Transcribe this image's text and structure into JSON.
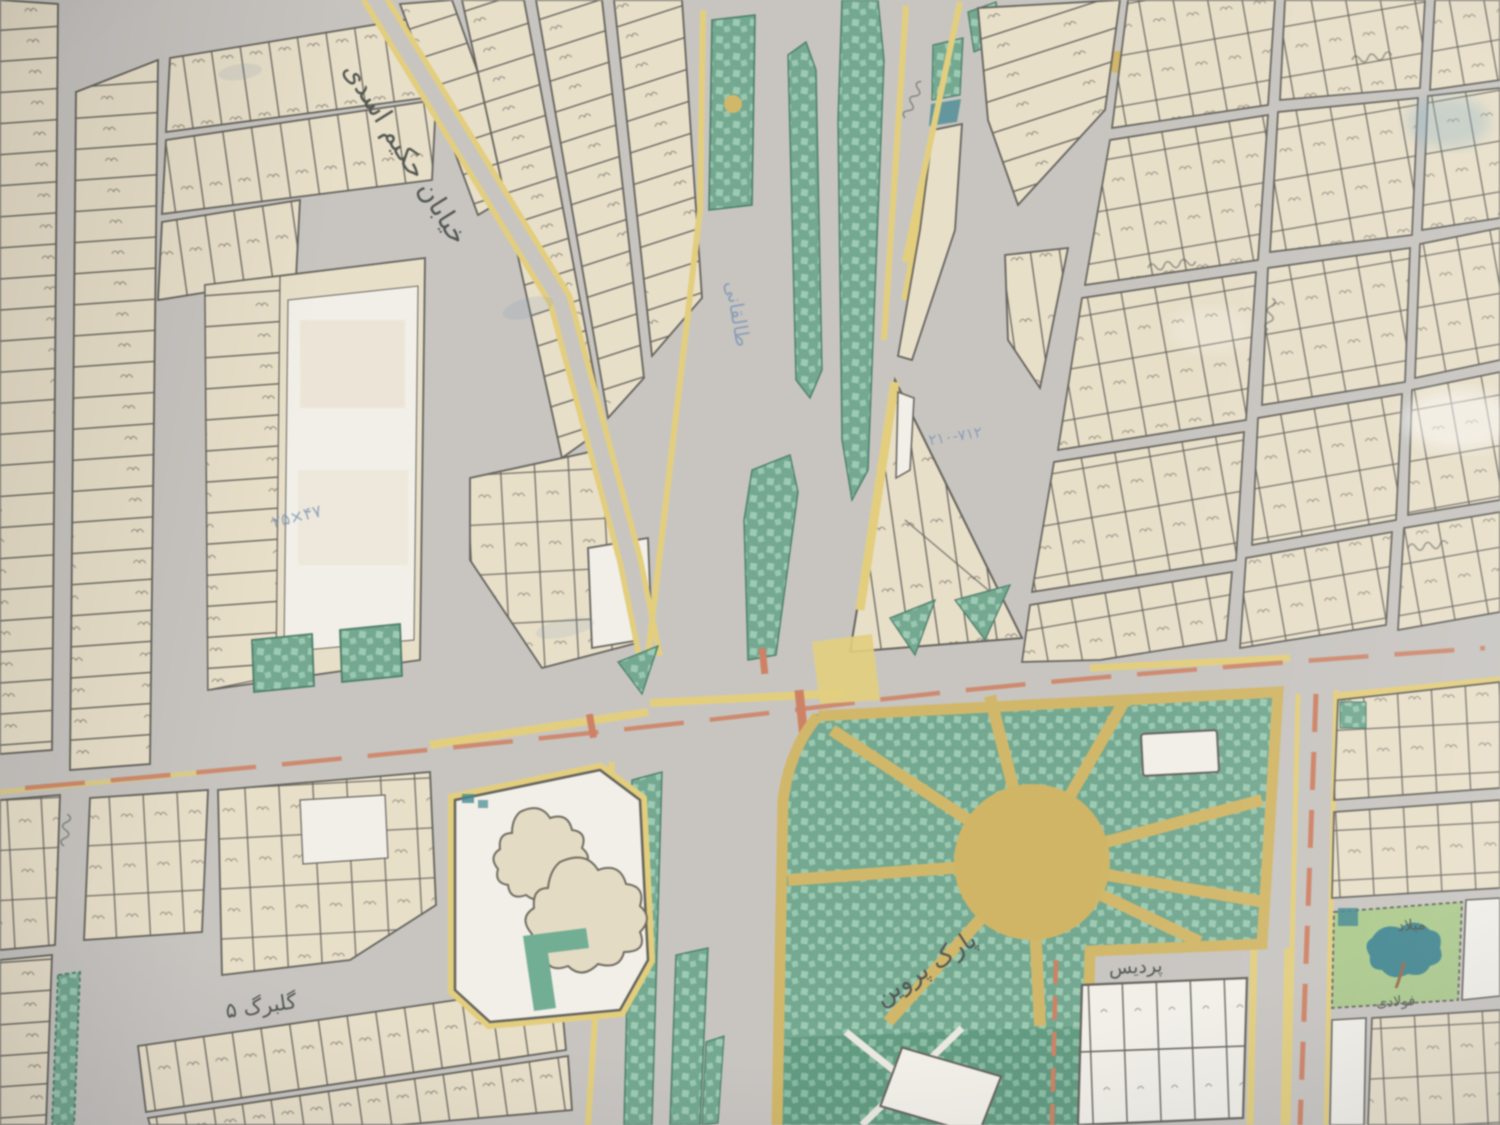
{
  "map": {
    "title": "photographed cadastral street map (Iran)",
    "labels": {
      "hakim_asadi": "خیابان حکیم اسدی",
      "taleghani": "طالقانی",
      "golbarg5": "گلبرگ ۵",
      "park_parvin": "پارک پروین",
      "pardis": "پردیس",
      "milad": "میلاد",
      "fooladi": "فولادی"
    },
    "annotations": {
      "dim1": "۲۵×۴۷",
      "dim2": "۲۱۰-۷۱۲"
    },
    "colors": {
      "road": "#c8c5bf",
      "parcel": "#ece0c4",
      "parcel_white": "#f4f1e8",
      "line": "#5f5d55",
      "green": "#66a98b",
      "green_spot": "#93cdaf",
      "green_dark": "#549b7c",
      "green_dark_spot": "#7fbf9f",
      "green_stroke": "#3c7c60",
      "edge_yellow": "#e9cf68",
      "path_yellow": "#d8b652",
      "plaza_yellow": "#d7b44e",
      "median_orange": "#dd7b55",
      "tree_teal": "#2f8793",
      "lawn_green": "#a6cd7e",
      "annotation_blue": "#7392bb",
      "ink": "#4b504b",
      "numeral_green": "#63b08e",
      "tree_beige": "#e8dcbe"
    }
  }
}
